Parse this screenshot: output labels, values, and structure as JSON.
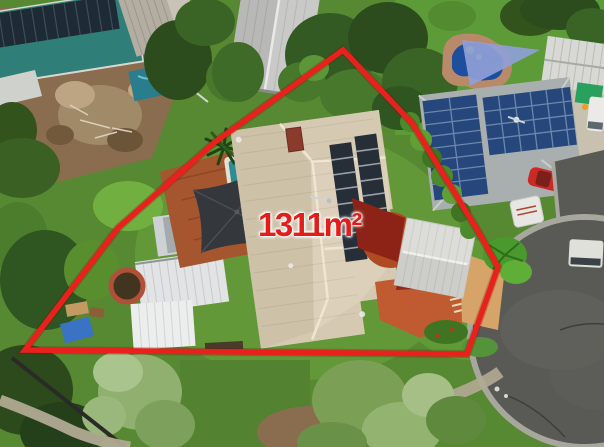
{
  "overlay": {
    "area_label": "1311m²",
    "boundary_color": "#e8211d",
    "label_color": "#e31d1a",
    "label_outline_color": "#ffffff",
    "boundary_points": "343,50 412,123 478,231 498,267 467,354 25,350 118,228 215,142"
  },
  "scene": {
    "elements": [
      {
        "name": "main-house-roof",
        "color": "#d5c9b2"
      },
      {
        "name": "main-house-solar-panels",
        "color": "#262e38"
      },
      {
        "name": "neighbor-roof",
        "color": "#a8afae"
      },
      {
        "name": "neighbor-solar-panels",
        "color": "#26477c"
      },
      {
        "name": "swimming-pool-water",
        "color": "#1d4f9e"
      },
      {
        "name": "pool-shade-sail",
        "color": "#8fa0d8"
      },
      {
        "name": "black-shade-sail",
        "color": "#34373c"
      },
      {
        "name": "red-shade-sail",
        "color": "#8c2316"
      },
      {
        "name": "timber-deck",
        "color": "#a5562f"
      },
      {
        "name": "garage-roof",
        "color": "#dcdcd8"
      },
      {
        "name": "lawn",
        "color": "#578832"
      },
      {
        "name": "road-asphalt",
        "color": "#595956"
      },
      {
        "name": "dirt-lot",
        "color": "#8a6d4e"
      },
      {
        "name": "red-car",
        "color": "#cc2824"
      },
      {
        "name": "white-caravan",
        "color": "#e6e6e2"
      },
      {
        "name": "boundary-hedge",
        "color": "#4c8a2b"
      }
    ]
  }
}
